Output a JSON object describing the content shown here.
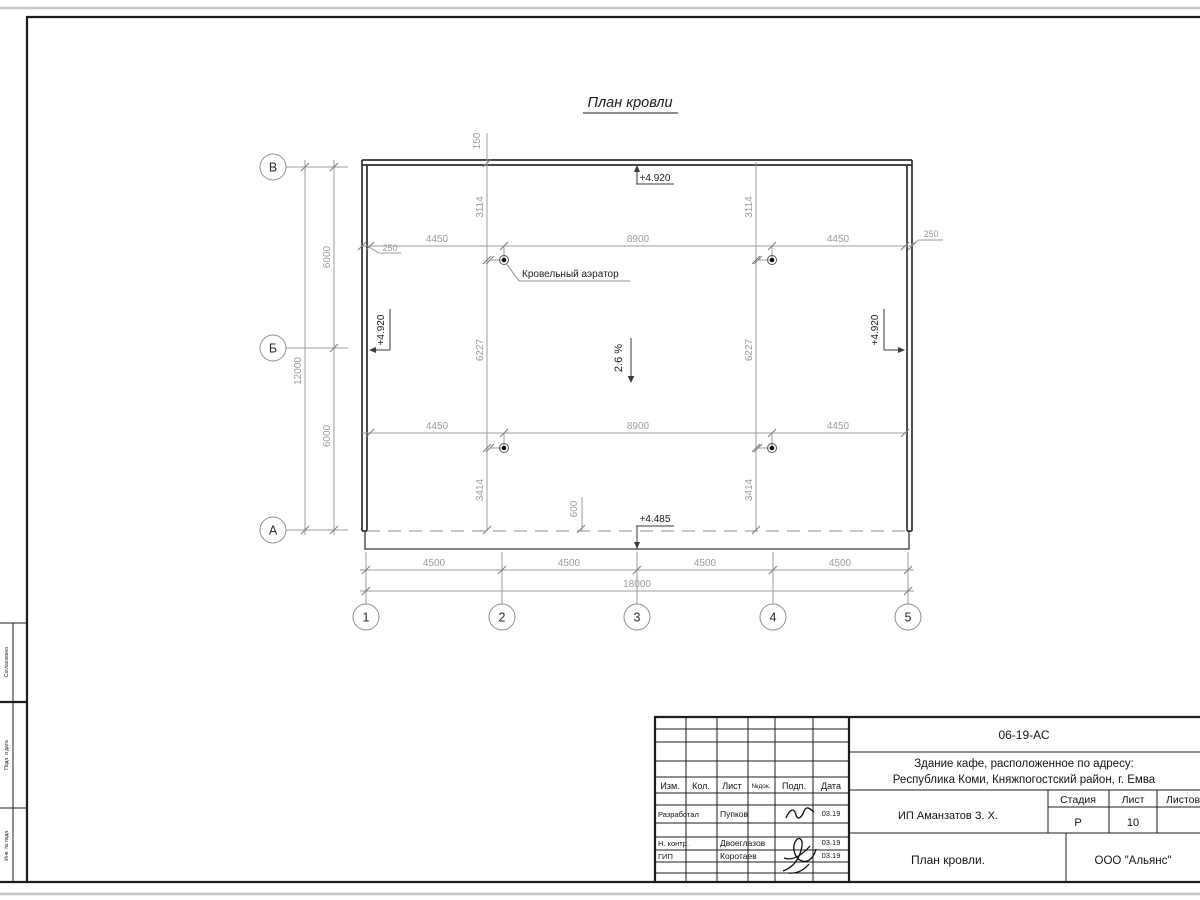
{
  "sheet": {
    "title": "План кровли"
  },
  "axes": {
    "rows": [
      "В",
      "Б",
      "А"
    ],
    "cols": [
      "1",
      "2",
      "3",
      "4",
      "5"
    ]
  },
  "dims": {
    "overhang_top": "150",
    "parapet_left": "250",
    "parapet_right": "250",
    "row_upper": [
      "4450",
      "8900",
      "4450"
    ],
    "row_lower": [
      "4450",
      "8900",
      "4450"
    ],
    "v_top": [
      "3114",
      "3114"
    ],
    "v_mid": [
      "6227",
      "6227"
    ],
    "v_bot": [
      "3414",
      "3414"
    ],
    "eave": "600",
    "left_spans": [
      "6000",
      "6000"
    ],
    "left_total": "12000",
    "bottom_spans": [
      "4500",
      "4500",
      "4500",
      "4500"
    ],
    "bottom_total": "18000"
  },
  "notes": {
    "aerator": "Кровельный аэратор",
    "slope": "2.6 %",
    "elev_top": "+4.920",
    "elev_left": "+4.920",
    "elev_right": "+4.920",
    "elev_eave": "+4.485"
  },
  "side_stamp": {
    "cell1": "Согласовано",
    "cell2": "Подп. и дата",
    "cell3": "Инв. № подл."
  },
  "title_block": {
    "doc_number": "06-19-АС",
    "project_line1": "Здание кафе, расположенное по адресу:",
    "project_line2": "Республика Коми, Княжпогостский район, г. Емва",
    "cols": [
      "Изм.",
      "Кол.",
      "Лист",
      "№док.",
      "Подп.",
      "Дата"
    ],
    "rows": [
      {
        "role": "Разработал",
        "name": "Пупков",
        "date": "03.19"
      },
      {
        "role": "Н. контр.",
        "name": "Двоеглазов",
        "date": "03.19"
      },
      {
        "role": "ГИП",
        "name": "Коротаев",
        "date": "03.19"
      }
    ],
    "client": "ИП Аманзатов З. Х.",
    "stage_label": "Стадия",
    "sheet_label": "Лист",
    "sheets_label": "Листов",
    "stage": "Р",
    "sheet": "10",
    "drawing_title": "План кровли.",
    "company": "ООО \"Альянс\""
  }
}
